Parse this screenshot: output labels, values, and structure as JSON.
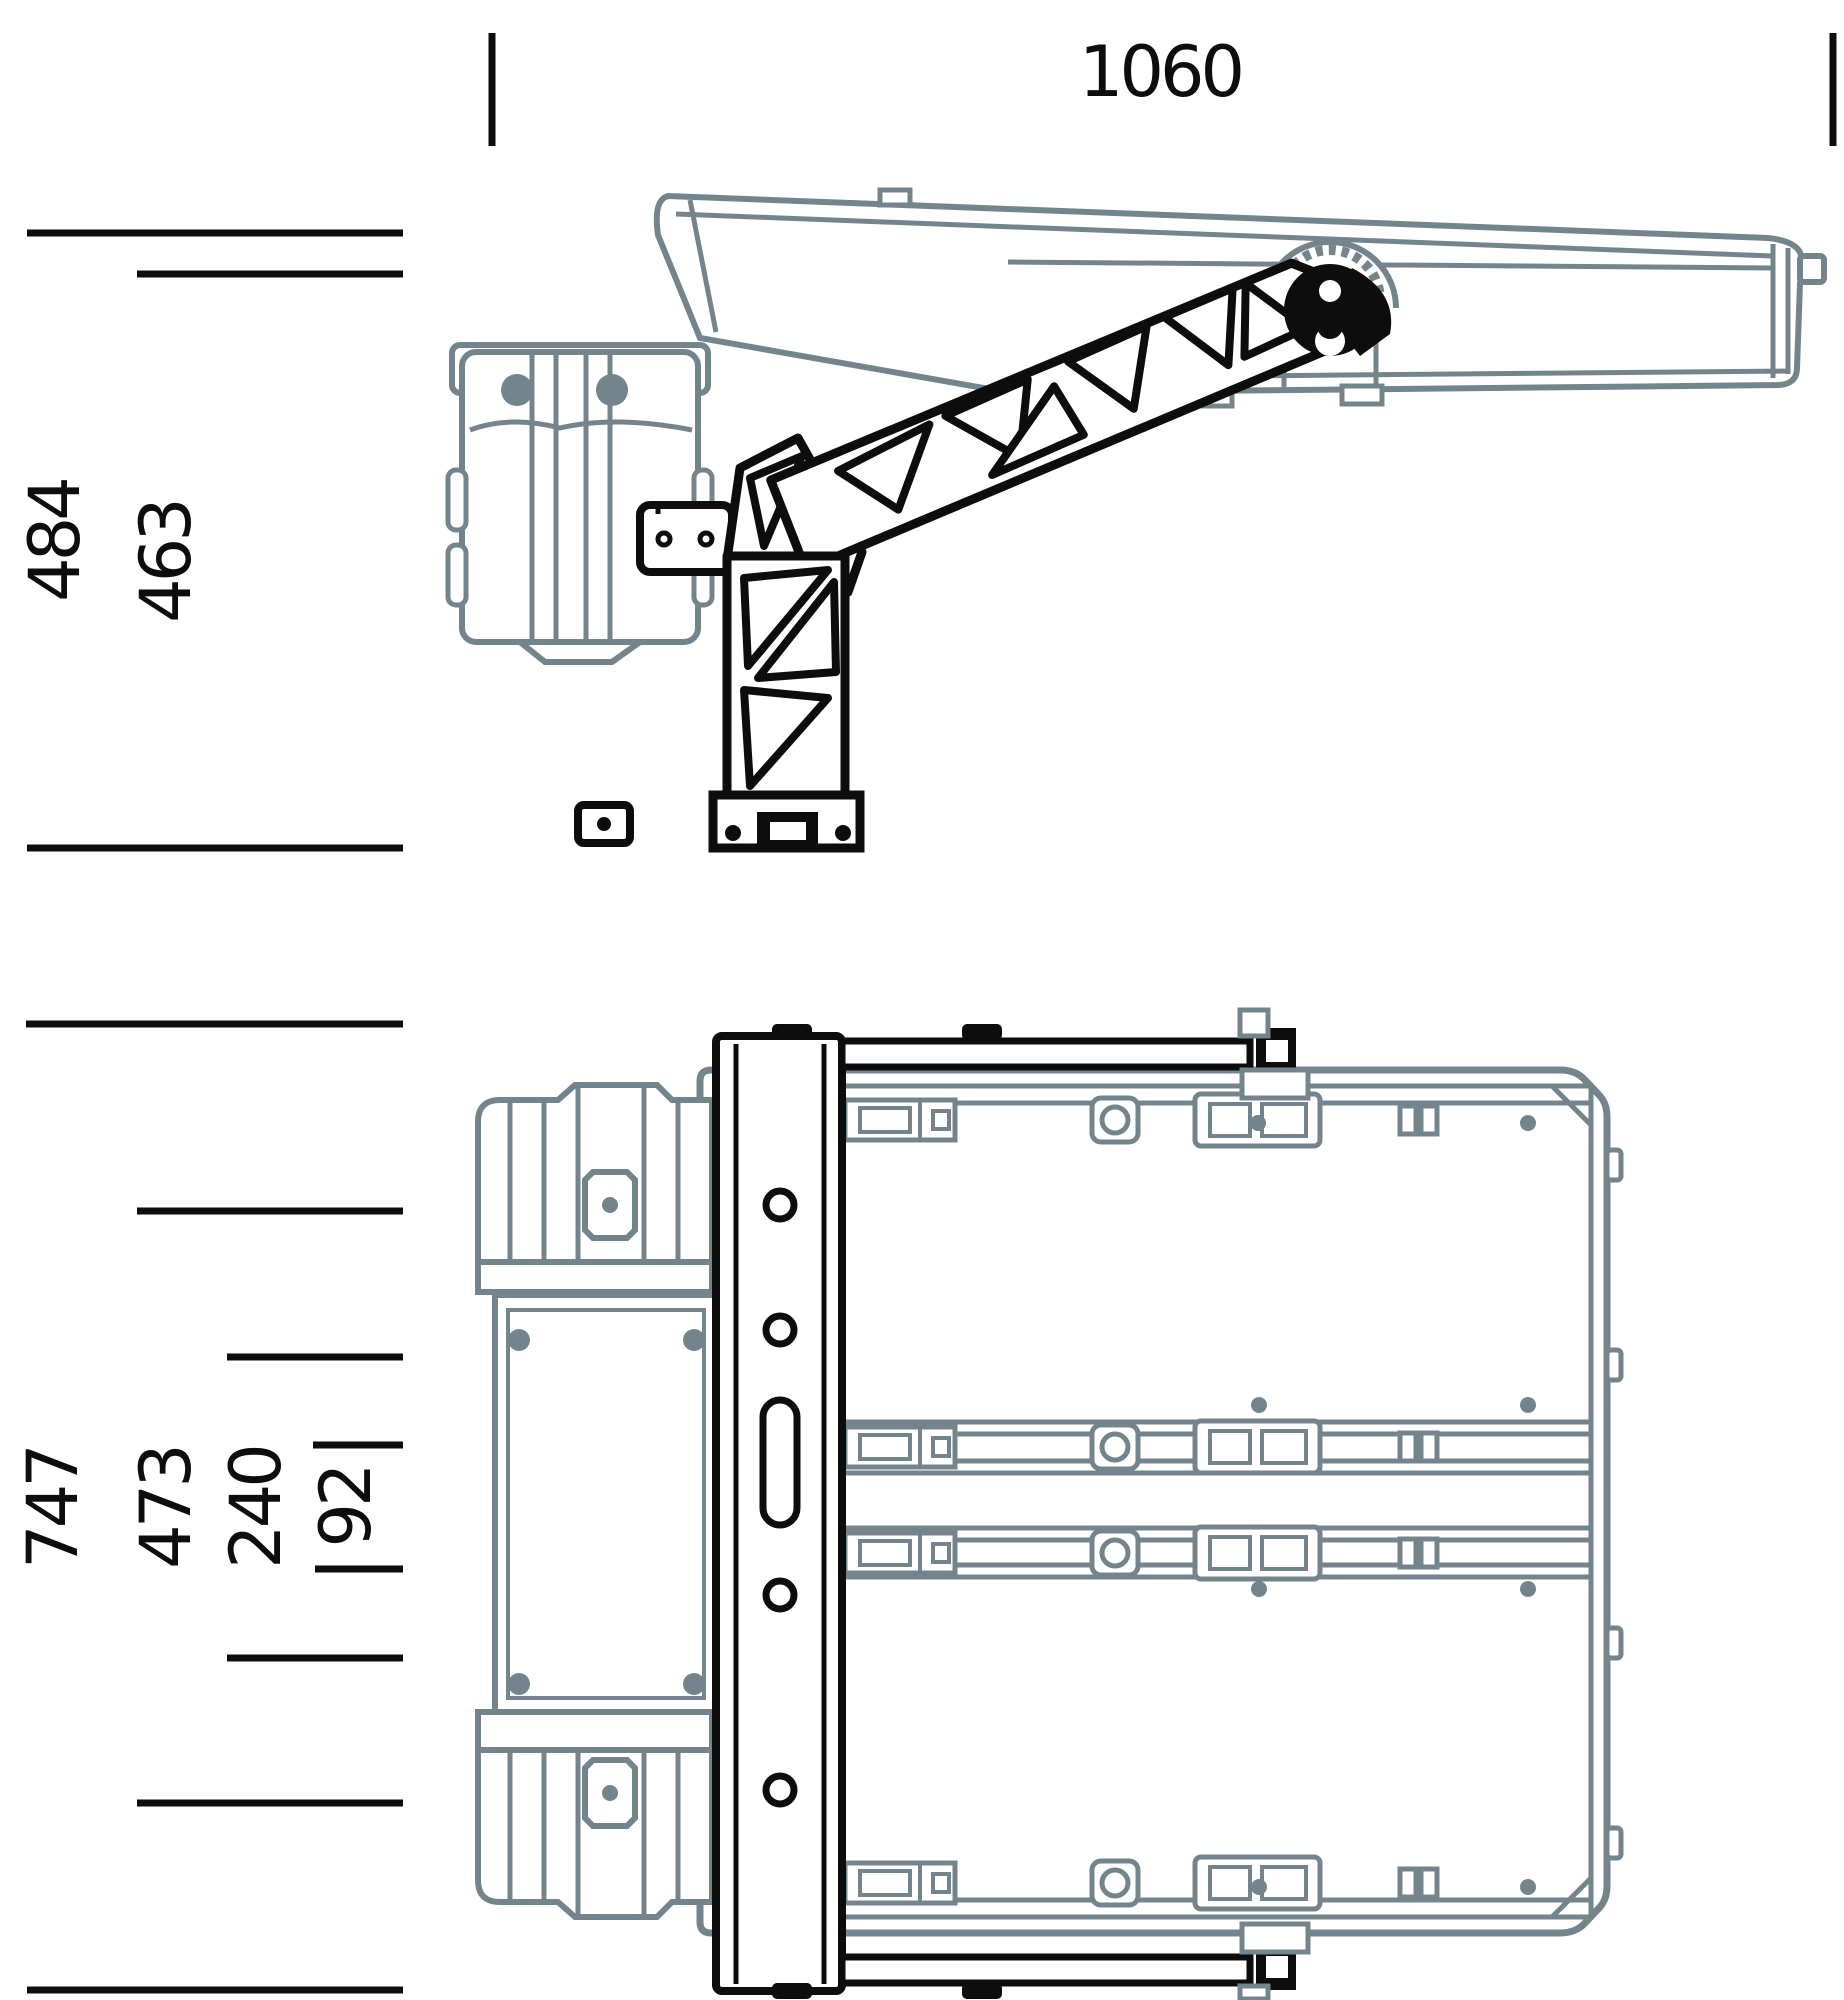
{
  "drawing": {
    "kind": "two-view technical drawing of fold-out panel mount",
    "views": {
      "side_view_name": "side elevation (folded panel on pivot arm)",
      "plan_view_name": "top plan (panel pair with mounting rail)"
    }
  },
  "dimensions": {
    "width": "1060",
    "side": [
      "484",
      "463"
    ],
    "plan": [
      "747",
      "473",
      "240",
      "92"
    ]
  },
  "colors": {
    "outline_black": "#0d0d0d",
    "component_gray": "#74848d",
    "background": "#ffffff"
  }
}
